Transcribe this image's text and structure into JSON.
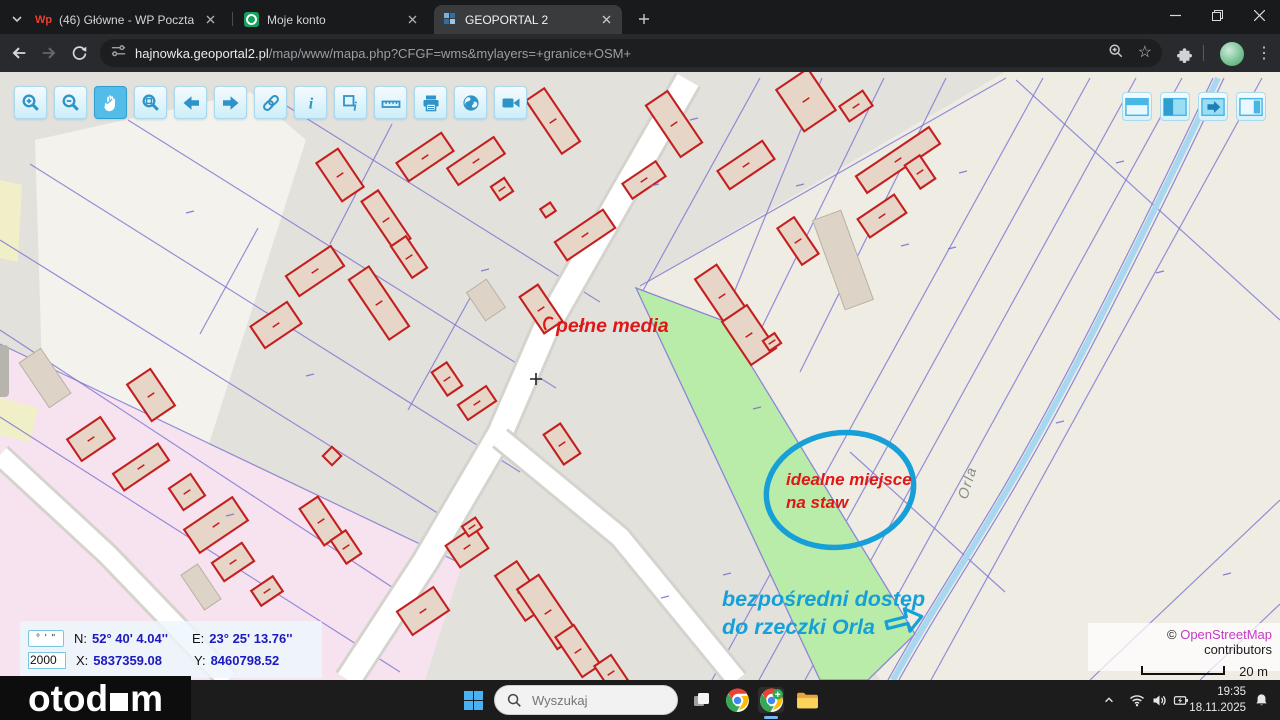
{
  "browser": {
    "tabs": [
      {
        "title": "(46) Główne - WP Poczta",
        "favicon": "wp-icon"
      },
      {
        "title": "Moje konto",
        "favicon": "account-icon"
      },
      {
        "title": "GEOPORTAL 2",
        "favicon": "geoportal-icon"
      }
    ],
    "url_host": "hajnowka.geoportal2.pl",
    "url_path": "/map/www/mapa.php?CFGF=wms&mylayers=+granice+OSM+"
  },
  "map_toolbar_icons": [
    "zoom-in",
    "zoom-out",
    "pan-hand",
    "zoom-box",
    "arrow-left",
    "arrow-right",
    "link",
    "info",
    "select-info",
    "measure",
    "print",
    "globe",
    "video"
  ],
  "map_panel_icons": [
    "layout-top",
    "layout-left",
    "layout-arrow",
    "layout-right"
  ],
  "map": {
    "annotations": {
      "pelne_media": "pełne media",
      "idealne_line1": "idealne miejsce",
      "idealne_line2": "na staw",
      "dostep_line1": "bezpośredni dostęp",
      "dostep_line2": "do rzeczki Orla",
      "river": "Orla"
    },
    "coords": {
      "dms_button": "° ' \"",
      "scale": "2000",
      "n_label": "N:",
      "n_value": "52° 40' 4.04''",
      "e_label": "E:",
      "e_value": "23° 25' 13.76''",
      "x_label": "X:",
      "x_value": "5837359.08",
      "y_label": "Y:",
      "y_value": "8460798.52"
    },
    "attribution": {
      "copyright": "©",
      "link": "OpenStreetMap",
      "suffix": "contributors",
      "scale_label": "20 m"
    }
  },
  "taskbar": {
    "search_placeholder": "Wyszukaj",
    "time": "19:35",
    "date": "18.11.2025"
  },
  "watermark": {
    "prefix": "otod",
    "suffix": "m"
  },
  "colors": {
    "annotation_red": "#e01717",
    "annotation_cyan": "#17a0d8",
    "parcel_green": "#b9eca8",
    "osm_link": "#c43bc4",
    "building_outline": "#c41f1f"
  }
}
